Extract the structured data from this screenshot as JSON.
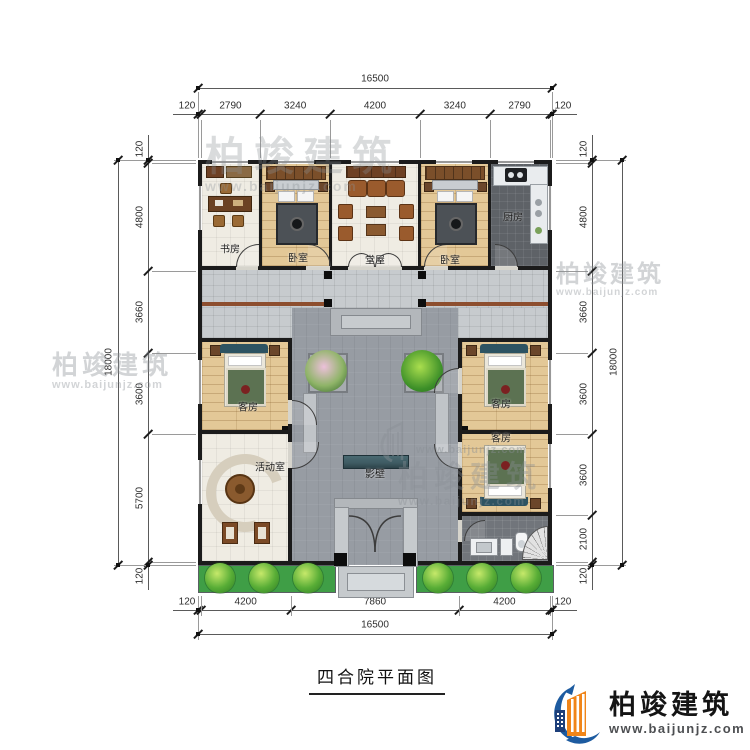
{
  "title": "四合院平面图",
  "brand": {
    "name": "柏竣建筑",
    "website": "www.baijunjz.com"
  },
  "dimensions": {
    "top": {
      "total": "16500",
      "segments": [
        "120",
        "2790",
        "3240",
        "4200",
        "3240",
        "2790",
        "120"
      ]
    },
    "bottom": {
      "total": "16500",
      "segments": [
        "120",
        "4200",
        "7860",
        "4200",
        "120"
      ]
    },
    "left": {
      "total": "18000",
      "segments": [
        "120",
        "4800",
        "3660",
        "3600",
        "5700",
        "120"
      ]
    },
    "right": {
      "total": "18000",
      "segments": [
        "120",
        "4800",
        "3660",
        "3600",
        "3600",
        "2100",
        "120"
      ]
    }
  },
  "rooms": {
    "study": "书房",
    "bedroom_left": "卧室",
    "hall": "堂屋",
    "bedroom_right": "卧室",
    "kitchen": "厨房",
    "guest_left": "客房",
    "guest_right_top": "客房",
    "guest_right_bottom": "客房",
    "activity": "活动室",
    "screen_wall": "影壁"
  },
  "colors": {
    "wall": "#1b1b1b",
    "courtyard_gray": "#979ca3",
    "wood_floor": "#e3c897",
    "hedge_green": "#3f9e46",
    "screen_wall_teal": "#3e5a62",
    "logo_blue": "#1d5ba0",
    "logo_orange": "#f08519"
  }
}
